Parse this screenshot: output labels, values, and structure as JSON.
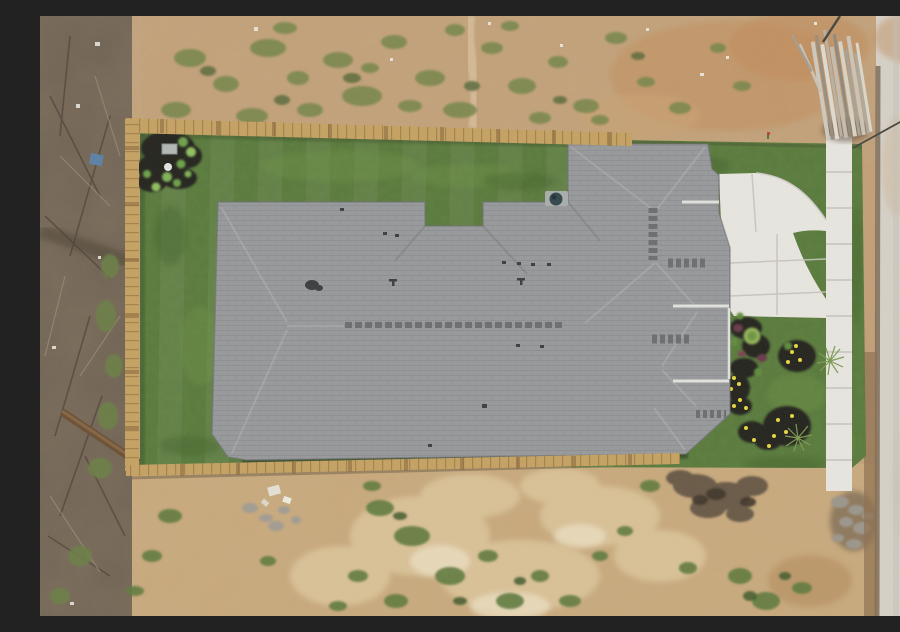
{
  "meta": {
    "type": "aerial-drone-photograph",
    "description": "Top-down drone photo of a newly built single-family house with a gray shingle roof, fenced backyard of fresh sod, white concrete walkway, sidewalk and driveway apron on the right, dark mulch landscape beds with yellow flowers, surrounded by a bare dirt construction lot, scrubland on the left, a concrete road on the right edge and a stack of lumber at top right",
    "canvas": {
      "width": 900,
      "height": 600
    }
  },
  "palette": {
    "dirt": "#c2a078",
    "dirt2": "#c9a97c",
    "sand": "#dcc49a",
    "scrub": "#6e6152",
    "lawn": "#567839",
    "lawnLight": "#6f9447",
    "lawnDark": "#41602c",
    "roof": "#97999c",
    "roofLine": "#84868a",
    "concrete": "#e9e7e1",
    "joint": "#c6c4bd",
    "road": "#d7d2c9",
    "curb": "#6f5d49",
    "fence": "#c6a262",
    "fenceDark": "#8a6a3c",
    "mulch": "#20221a",
    "shrub": "#8fb057",
    "flower": "#e8d83f",
    "redplant": "#6a3848",
    "weed": "#75854a",
    "weedDark": "#5a6b3a",
    "log": "#6b4f33",
    "tarp": "#5b80a6",
    "wire": "#46463e",
    "vent": "#3a3c3f",
    "shadow": "#2e4023"
  },
  "scene": {
    "house": {
      "roof": "gray asphalt shingle hip roof, L-shaped footprint with front wing",
      "features": [
        "long ridge vent",
        "plumbing vent pipes",
        "teal attic fan at rear wall",
        "white eave lines on right bump-out"
      ]
    },
    "backyard": {
      "lawn": "fresh green sod with mow stripes",
      "fence": "new wood privacy fence on left, top and bottom sides",
      "corner_bed": "black mulch bed with young shrubs, gray utility box and white sprinkler head"
    },
    "front_yard": {
      "walkway": "white concrete walk curving from house to sidewalk",
      "sidewalk": "concrete sidewalk strip running vertically on right",
      "driveway_apron": "white concrete apron in front of house",
      "landscaping": [
        "mulch islands",
        "yellow flowering plants",
        "wispy ornamental shrubs",
        "green lawn"
      ]
    },
    "surroundings": {
      "left": "dark brown scrubland with fallen branches and a small blue tarp scrap",
      "top": "bare tan dirt with scattered weed patches and white debris",
      "right": "pale concrete road with dirt shoulder and curb line",
      "bottom": "sandy disturbed ground with weeds, gray rubble, dark debris and white trash",
      "top_right": "stack of gray lumber boards beside sidewalk end, thin utility wire crossing the corner"
    }
  }
}
